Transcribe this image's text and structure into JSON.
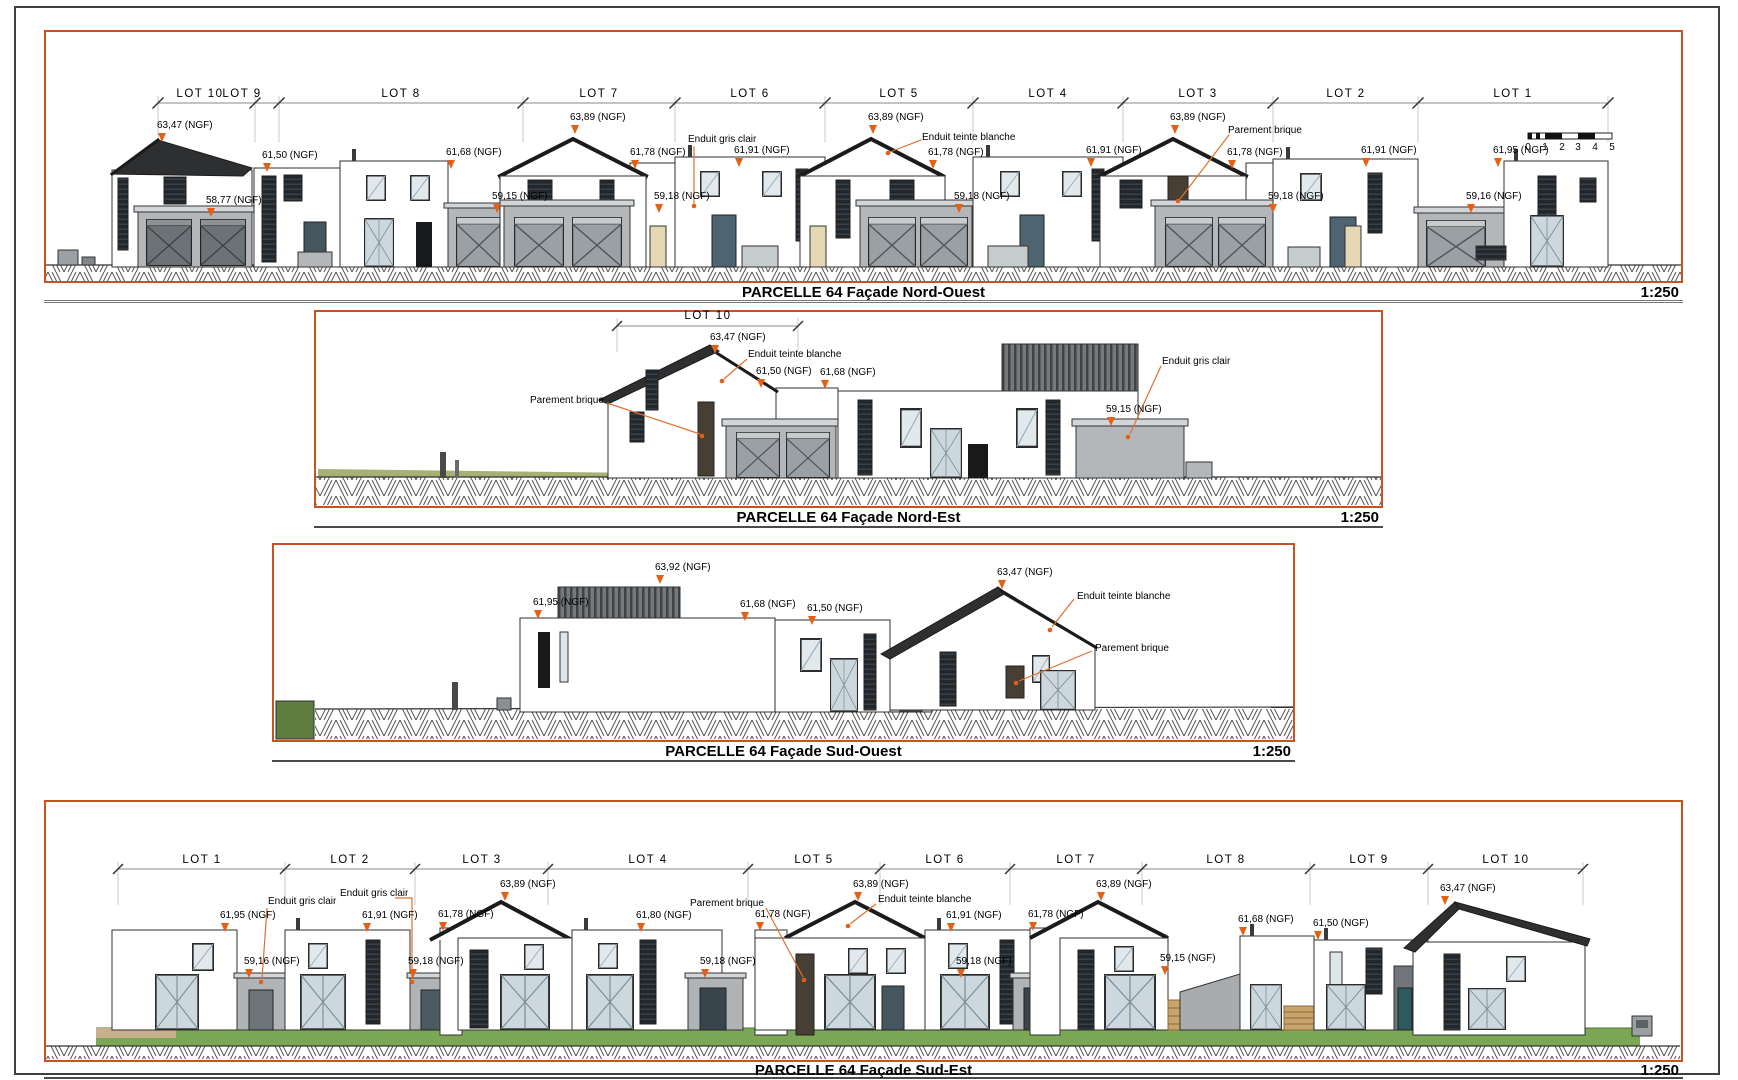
{
  "document": {
    "kind": "architectural elevation sheet",
    "parcel": "PARCELLE 64",
    "colors": {
      "panel_border": "#c8531c",
      "marker_orange": "#e55f15",
      "leader_orange": "#e07030",
      "roof_dark": "#2d2f31",
      "garage_grey": "#b3b7ba",
      "grass_green": "#7ca855"
    }
  },
  "p1": {
    "title": "PARCELLE 64 Façade Nord-Ouest",
    "scale": "1:250",
    "lots": [
      "LOT 10",
      "LOT 9",
      "LOT 8",
      "LOT 7",
      "LOT 6",
      "LOT 5",
      "LOT 4",
      "LOT 3",
      "LOT 2",
      "LOT 1"
    ],
    "ann": [
      "63,47 (NGF)",
      "61,50 (NGF)",
      "58,77 (NGF)",
      "61,68 (NGF)",
      "59,15 (NGF)",
      "63,89 (NGF)",
      "61,78 (NGF)",
      "Enduit gris clair",
      "59,18 (NGF)",
      "61,91 (NGF)",
      "63,89 (NGF)",
      "Enduit teinte blanche",
      "61,78 (NGF)",
      "59,18 (NGF)",
      "61,91 (NGF)",
      "63,89 (NGF)",
      "Parement brique",
      "61,78 (NGF)",
      "59,18 (NGF)",
      "61,91 (NGF)",
      "61,95 (NGF)",
      "59,16 (NGF)"
    ],
    "ruler": [
      "0",
      "1",
      "2",
      "3",
      "4",
      "5"
    ]
  },
  "p2": {
    "title": "PARCELLE 64 Façade Nord-Est",
    "scale": "1:250",
    "lot": "LOT 10",
    "ann": [
      "63,47 (NGF)",
      "Enduit teinte blanche",
      "61,50 (NGF)",
      "61,68 (NGF)",
      "Enduit gris clair",
      "Parement brique",
      "59,15 (NGF)"
    ]
  },
  "p3": {
    "title": "PARCELLE 64 Façade Sud-Ouest",
    "scale": "1:250",
    "ann": [
      "63,92 (NGF)",
      "61,95 (NGF)",
      "61,68 (NGF)",
      "61,50 (NGF)",
      "63,47 (NGF)",
      "Enduit teinte blanche",
      "Parement brique"
    ]
  },
  "p4": {
    "title": "PARCELLE 64 Façade Sud-Est",
    "scale": "1:250",
    "lots": [
      "LOT 1",
      "LOT 2",
      "LOT 3",
      "LOT 4",
      "LOT 5",
      "LOT 6",
      "LOT 7",
      "LOT 8",
      "LOT 9",
      "LOT 10"
    ],
    "ann": [
      "61,95 (NGF)",
      "Enduit gris clair",
      "Enduit gris clair",
      "59,16 (NGF)",
      "61,91 (NGF)",
      "59,18 (NGF)",
      "61,78 (NGF)",
      "63,89 (NGF)",
      "61,80 (NGF)",
      "Parement brique",
      "61,78 (NGF)",
      "63,89 (NGF)",
      "Enduit teinte blanche",
      "61,91 (NGF)",
      "59,18 (NGF)",
      "59,18 (NGF)",
      "61,78 (NGF)",
      "63,89 (NGF)",
      "59,15 (NGF)",
      "61,68 (NGF)",
      "61,50 (NGF)",
      "63,47 (NGF)"
    ]
  }
}
